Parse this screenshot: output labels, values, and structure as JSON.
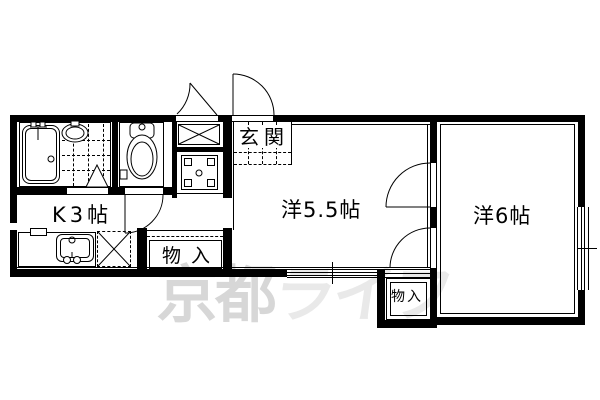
{
  "floorplan": {
    "rooms": {
      "entrance": {
        "label": "玄関"
      },
      "kitchen": {
        "label": "K3帖"
      },
      "western_room_55": {
        "label": "洋5.5帖"
      },
      "western_room_6": {
        "label": "洋6帖"
      },
      "storage_upper": {
        "label": "物入"
      },
      "storage_lower": {
        "label": "物入"
      }
    },
    "watermark": {
      "part1": "京都",
      "part2": "ライフ",
      "full_text": "京都ライフ"
    },
    "colors": {
      "line": "#000000",
      "background": "#ffffff",
      "watermark_dark": "#d7d7d7",
      "watermark_light": "#e9e9e9"
    }
  }
}
